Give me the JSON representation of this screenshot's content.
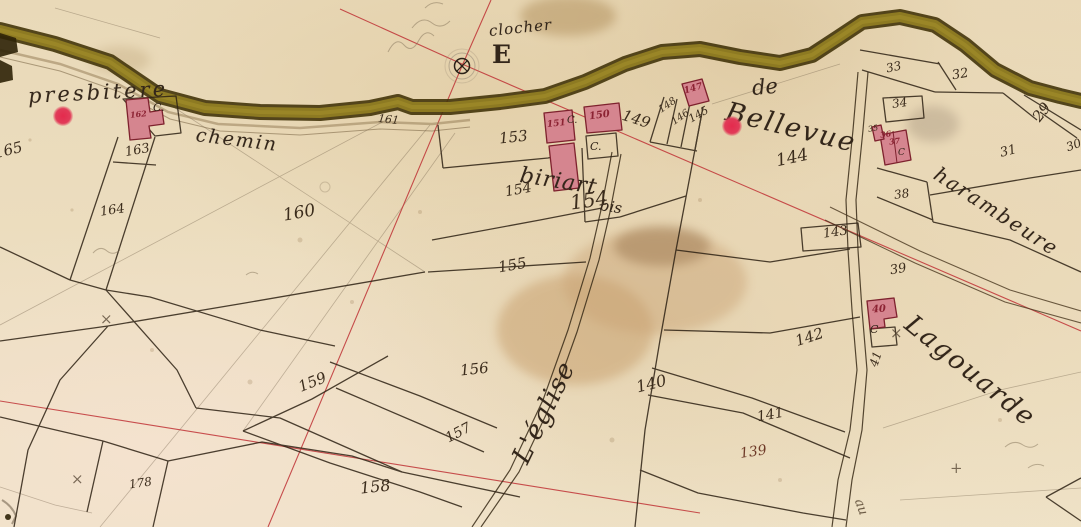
{
  "map": {
    "colors": {
      "paper": "#ecdec0",
      "road_olive": "#8d7a22",
      "road_edge": "#43340a",
      "ink": "#33261a",
      "building_fill": "#d5858f",
      "building_stroke": "#7e222e",
      "building_number_red": "#8c2333",
      "survey_line_red": "#bf3336",
      "marker_red": "#e42a4d",
      "stain_tan": "#c69d6b"
    },
    "place_labels": [
      {
        "name": "label-presbitere",
        "text": "presbitere",
        "x": 28,
        "y": 84,
        "size": 21,
        "rot": -3,
        "ls": 3
      },
      {
        "name": "label-chemin",
        "text": "chemin",
        "x": 196,
        "y": 124,
        "size": 19,
        "rot": 7,
        "ls": 2
      },
      {
        "name": "label-clocher",
        "text": "clocher",
        "x": 489,
        "y": 22,
        "size": 15,
        "rot": -6,
        "ls": 1
      },
      {
        "name": "label-letter-e",
        "text": "E",
        "x": 492,
        "y": 40,
        "size": 25,
        "rot": 0,
        "upright": true,
        "bold": true
      },
      {
        "name": "label-de",
        "text": "de",
        "x": 752,
        "y": 76,
        "size": 21,
        "rot": -5
      },
      {
        "name": "label-bellevue",
        "text": "Bellevue",
        "x": 726,
        "y": 96,
        "size": 27,
        "rot": 14,
        "ls": 2
      },
      {
        "name": "label-biriart",
        "text": "biriart",
        "x": 520,
        "y": 163,
        "size": 22,
        "rot": 9,
        "ls": 1
      },
      {
        "name": "label-bis",
        "text": "bis",
        "x": 600,
        "y": 196,
        "size": 15,
        "rot": 9
      },
      {
        "name": "label-leglise",
        "text": "L'église",
        "x": 520,
        "y": 447,
        "size": 26,
        "rot": -64,
        "ls": 1
      },
      {
        "name": "label-lagouarde",
        "text": "Lagouarde",
        "x": 908,
        "y": 306,
        "size": 26,
        "rot": 39,
        "ls": 2
      },
      {
        "name": "label-harambeure",
        "text": "harambeure",
        "x": 936,
        "y": 160,
        "size": 20,
        "rot": 33,
        "ls": 2
      },
      {
        "name": "label-au",
        "text": "au",
        "x": 858,
        "y": 492,
        "size": 13,
        "rot": 70,
        "color": "#6b5a45"
      }
    ],
    "parcel_numbers": [
      {
        "text": "165",
        "x": -6,
        "y": 141,
        "size": 15,
        "rot": -14
      },
      {
        "text": "163",
        "x": 125,
        "y": 143,
        "size": 13,
        "rot": -10
      },
      {
        "text": "164",
        "x": 100,
        "y": 203,
        "size": 13,
        "rot": -8
      },
      {
        "text": "161",
        "x": 378,
        "y": 113,
        "size": 11,
        "rot": 6
      },
      {
        "text": "160",
        "x": 283,
        "y": 203,
        "size": 17,
        "rot": -10
      },
      {
        "text": "153",
        "x": 499,
        "y": 128,
        "size": 15,
        "rot": -6
      },
      {
        "text": "149",
        "x": 622,
        "y": 110,
        "size": 15,
        "rot": 18
      },
      {
        "text": "148",
        "x": 658,
        "y": 100,
        "size": 10,
        "rot": -35
      },
      {
        "text": "146",
        "x": 671,
        "y": 112,
        "size": 10,
        "rot": -35
      },
      {
        "text": "145",
        "x": 688,
        "y": 108,
        "size": 11,
        "rot": -30
      },
      {
        "text": "144",
        "x": 776,
        "y": 148,
        "size": 17,
        "rot": -12
      },
      {
        "text": "154",
        "x": 505,
        "y": 182,
        "size": 14,
        "rot": -10
      },
      {
        "text": "154",
        "x": 570,
        "y": 188,
        "size": 20,
        "rot": -8
      },
      {
        "text": "155",
        "x": 498,
        "y": 256,
        "size": 15,
        "rot": -10
      },
      {
        "text": "156",
        "x": 460,
        "y": 360,
        "size": 15,
        "rot": -6
      },
      {
        "text": "157",
        "x": 445,
        "y": 425,
        "size": 14,
        "rot": -28
      },
      {
        "text": "158",
        "x": 360,
        "y": 477,
        "size": 16,
        "rot": -6
      },
      {
        "text": "159",
        "x": 298,
        "y": 373,
        "size": 15,
        "rot": -22
      },
      {
        "text": "178",
        "x": 129,
        "y": 476,
        "size": 12,
        "rot": -8
      },
      {
        "text": "140",
        "x": 636,
        "y": 374,
        "size": 16,
        "rot": -14
      },
      {
        "text": "141",
        "x": 757,
        "y": 407,
        "size": 14,
        "rot": -10
      },
      {
        "text": "139",
        "x": 740,
        "y": 444,
        "size": 14,
        "rot": -8,
        "color": "#6e3a28"
      },
      {
        "text": "142",
        "x": 795,
        "y": 328,
        "size": 15,
        "rot": -18
      },
      {
        "text": "143",
        "x": 823,
        "y": 225,
        "size": 13,
        "rot": -8
      },
      {
        "text": "39",
        "x": 890,
        "y": 262,
        "size": 13,
        "rot": -10
      },
      {
        "text": "41",
        "x": 868,
        "y": 352,
        "size": 12,
        "rot": -72
      },
      {
        "text": "33",
        "x": 886,
        "y": 60,
        "size": 12,
        "rot": -12
      },
      {
        "text": "32",
        "x": 952,
        "y": 67,
        "size": 13,
        "rot": -10
      },
      {
        "text": "34",
        "x": 892,
        "y": 96,
        "size": 12,
        "rot": -8
      },
      {
        "text": "31",
        "x": 1000,
        "y": 144,
        "size": 13,
        "rot": -14
      },
      {
        "text": "38",
        "x": 894,
        "y": 187,
        "size": 12,
        "rot": -8
      },
      {
        "text": "29",
        "x": 1032,
        "y": 103,
        "size": 15,
        "rot": -52
      },
      {
        "text": "30",
        "x": 1066,
        "y": 138,
        "size": 12,
        "rot": -20
      },
      {
        "text": "35",
        "x": 868,
        "y": 124,
        "size": 8,
        "rot": -10
      }
    ],
    "building_numbers": [
      {
        "text": "162",
        "x": 130,
        "y": 109,
        "size": 8,
        "rot": -6
      },
      {
        "text": "151",
        "x": 547,
        "y": 119,
        "size": 9,
        "rot": -6
      },
      {
        "text": "150",
        "x": 589,
        "y": 110,
        "size": 10,
        "rot": -8
      },
      {
        "text": "147",
        "x": 684,
        "y": 84,
        "size": 9,
        "rot": -16
      },
      {
        "text": "40",
        "x": 872,
        "y": 304,
        "size": 10,
        "rot": -4
      },
      {
        "text": "36",
        "x": 880,
        "y": 129,
        "size": 8,
        "rot": -8
      },
      {
        "text": "37",
        "x": 889,
        "y": 136,
        "size": 8,
        "rot": -8
      }
    ],
    "courtyard_marks": [
      {
        "text": "C.",
        "x": 153,
        "y": 101,
        "size": 11
      },
      {
        "text": "C.",
        "x": 567,
        "y": 115,
        "size": 10
      },
      {
        "text": "C.",
        "x": 590,
        "y": 140,
        "size": 11
      },
      {
        "text": "C",
        "x": 870,
        "y": 323,
        "size": 11
      },
      {
        "text": "C",
        "x": 898,
        "y": 148,
        "size": 9
      }
    ],
    "x_marks": [
      {
        "text": "×",
        "x": 100,
        "y": 310
      },
      {
        "text": "×",
        "x": 71,
        "y": 470
      },
      {
        "text": "×",
        "x": 890,
        "y": 324
      },
      {
        "text": "+",
        "x": 950,
        "y": 459
      }
    ],
    "red_markers": [
      {
        "x": 53,
        "y": 106,
        "rad": 10
      },
      {
        "x": 722,
        "y": 116,
        "rad": 10
      }
    ],
    "landmark": {
      "clocher_symbol": "circled-cross"
    }
  }
}
